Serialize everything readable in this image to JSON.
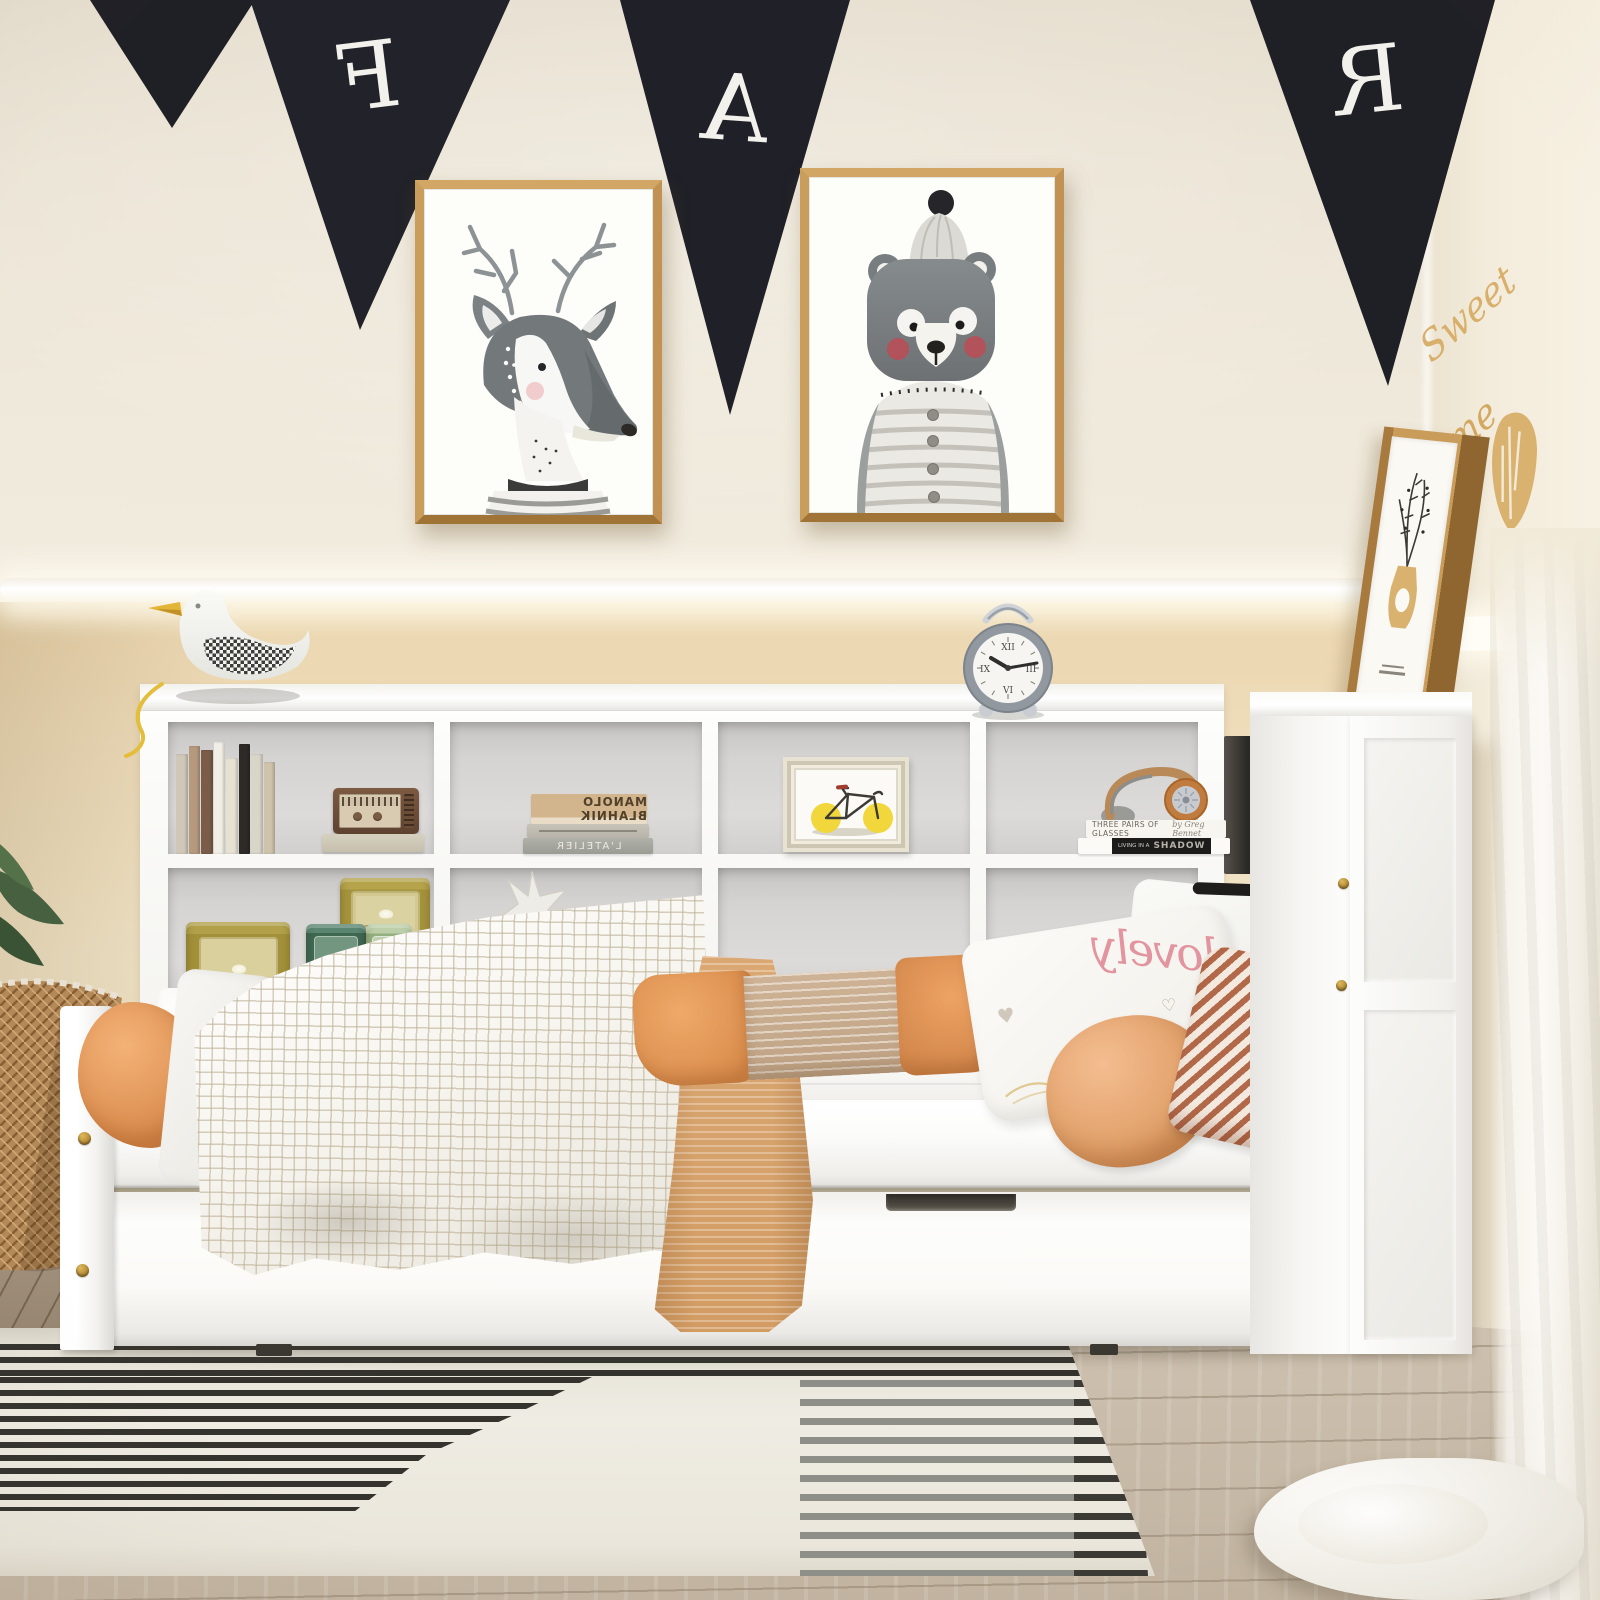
{
  "scene": {
    "description": "Warm kids-bedroom product photo: white twin daybed with L-shaped bookcase headboard, side storage tower and trundle drawer, black pennant banner and two animal watercolor prints on the wall, striped rug on light wood floor"
  },
  "palette": {
    "wall_upper": "#ede6d8",
    "wall_lower": "#eedcba",
    "wall_right": "#f4eedf",
    "led_glow": "#ffffff",
    "floor_wood": "#c9bcaa",
    "rug_base": "#efece3",
    "rug_stripe": "#34332e",
    "bed_white": "#fbfbf9",
    "cubby_gray": "#d6d5d3",
    "brass_hardware": "#c59a47",
    "banner_black": "#202127",
    "banner_letter": "#f2f1ec",
    "frame_wood": "#c19254",
    "bolster_orange": "#e89e63",
    "peach_pillow": "#e8ab79",
    "rust_stripe": "#b26949",
    "tan_runner": "#d9a46e",
    "tin_gold": "#a6943c",
    "tin_green_dark": "#47705a",
    "tin_green_light": "#a6c192",
    "radio_brown": "#6b4a33",
    "bike_wheel_yellow": "#f2d73c",
    "headphones_tan": "#c07c3e",
    "script_pink": "#e2949f",
    "sweet_home_gold": "#d8af6b",
    "curtain": "#f7f4ed"
  },
  "banner": {
    "letters": [
      "F",
      "A",
      "R"
    ],
    "mirrored": true
  },
  "wall_art": {
    "left_frame_subject": "watercolor deer with antlers and striped sweater",
    "right_frame_subject": "watercolor bear wearing pompom beanie and striped pajamas",
    "corner_frame_subject": "leaning wood frame with vase-and-branch sketch"
  },
  "decor": {
    "word1": "Sweet",
    "word2": "Home"
  },
  "clock": {
    "numerals": [
      "XII",
      "III",
      "VI",
      "IX"
    ],
    "time_shown": "10:13",
    "body_color": "#9198a0"
  },
  "shelf": {
    "book_stack_top": "MANOLO BLAHNIK",
    "book_stack_bottom": "L'ATELIER",
    "hp_title1": "THREE PAIRS OF GLASSES",
    "hp_author1": "by Greg Bennet",
    "hp_title2_prefix": "LIVING IN A",
    "hp_title2_word": "SHADOW",
    "book_spine_colors": [
      "#cfc7b7",
      "#b59a7e",
      "#7a5c49",
      "#f1eee6",
      "#e7e1d3",
      "#2e2a27",
      "#dad5c9",
      "#cfc3ac"
    ]
  },
  "pillows": {
    "script_word": "lovely",
    "heart1": "♥",
    "heart2": "♥",
    "heart3": "♡"
  },
  "objects": [
    {
      "name": "pennant-banner",
      "description": "black triangle flags with white letters"
    },
    {
      "name": "seagull-figurine",
      "description": "white bird with yellow beak and houndstooth wing on headboard top"
    },
    {
      "name": "alarm-clock",
      "description": "gray retro alarm clock with carry handle"
    },
    {
      "name": "vintage-radio",
      "description": "small brown radio standing on a book"
    },
    {
      "name": "bicycle-print",
      "description": "framed print of bicycle with lemon-yellow wheels"
    },
    {
      "name": "headphones",
      "description": "tan over-ear headphones resting on two books"
    },
    {
      "name": "tea-tins",
      "description": "gold and green decorative tins"
    },
    {
      "name": "starfish-ornament",
      "description": "white starfish on a small stand"
    },
    {
      "name": "waffle-blanket",
      "description": "white checkered waffle blanket"
    },
    {
      "name": "orange-throw",
      "description": "rumpled orange throw on left corner"
    },
    {
      "name": "knit-runner",
      "description": "camel knit runner draped over the bed front"
    },
    {
      "name": "trundle-drawer",
      "description": "white pull-out drawer with notch handle"
    },
    {
      "name": "striped-rug",
      "description": "cream rug with black stripe blocks"
    },
    {
      "name": "wicker-stool",
      "description": "woven rattan stool at left edge"
    },
    {
      "name": "sheer-curtain",
      "description": "white curtain at right edge"
    }
  ]
}
